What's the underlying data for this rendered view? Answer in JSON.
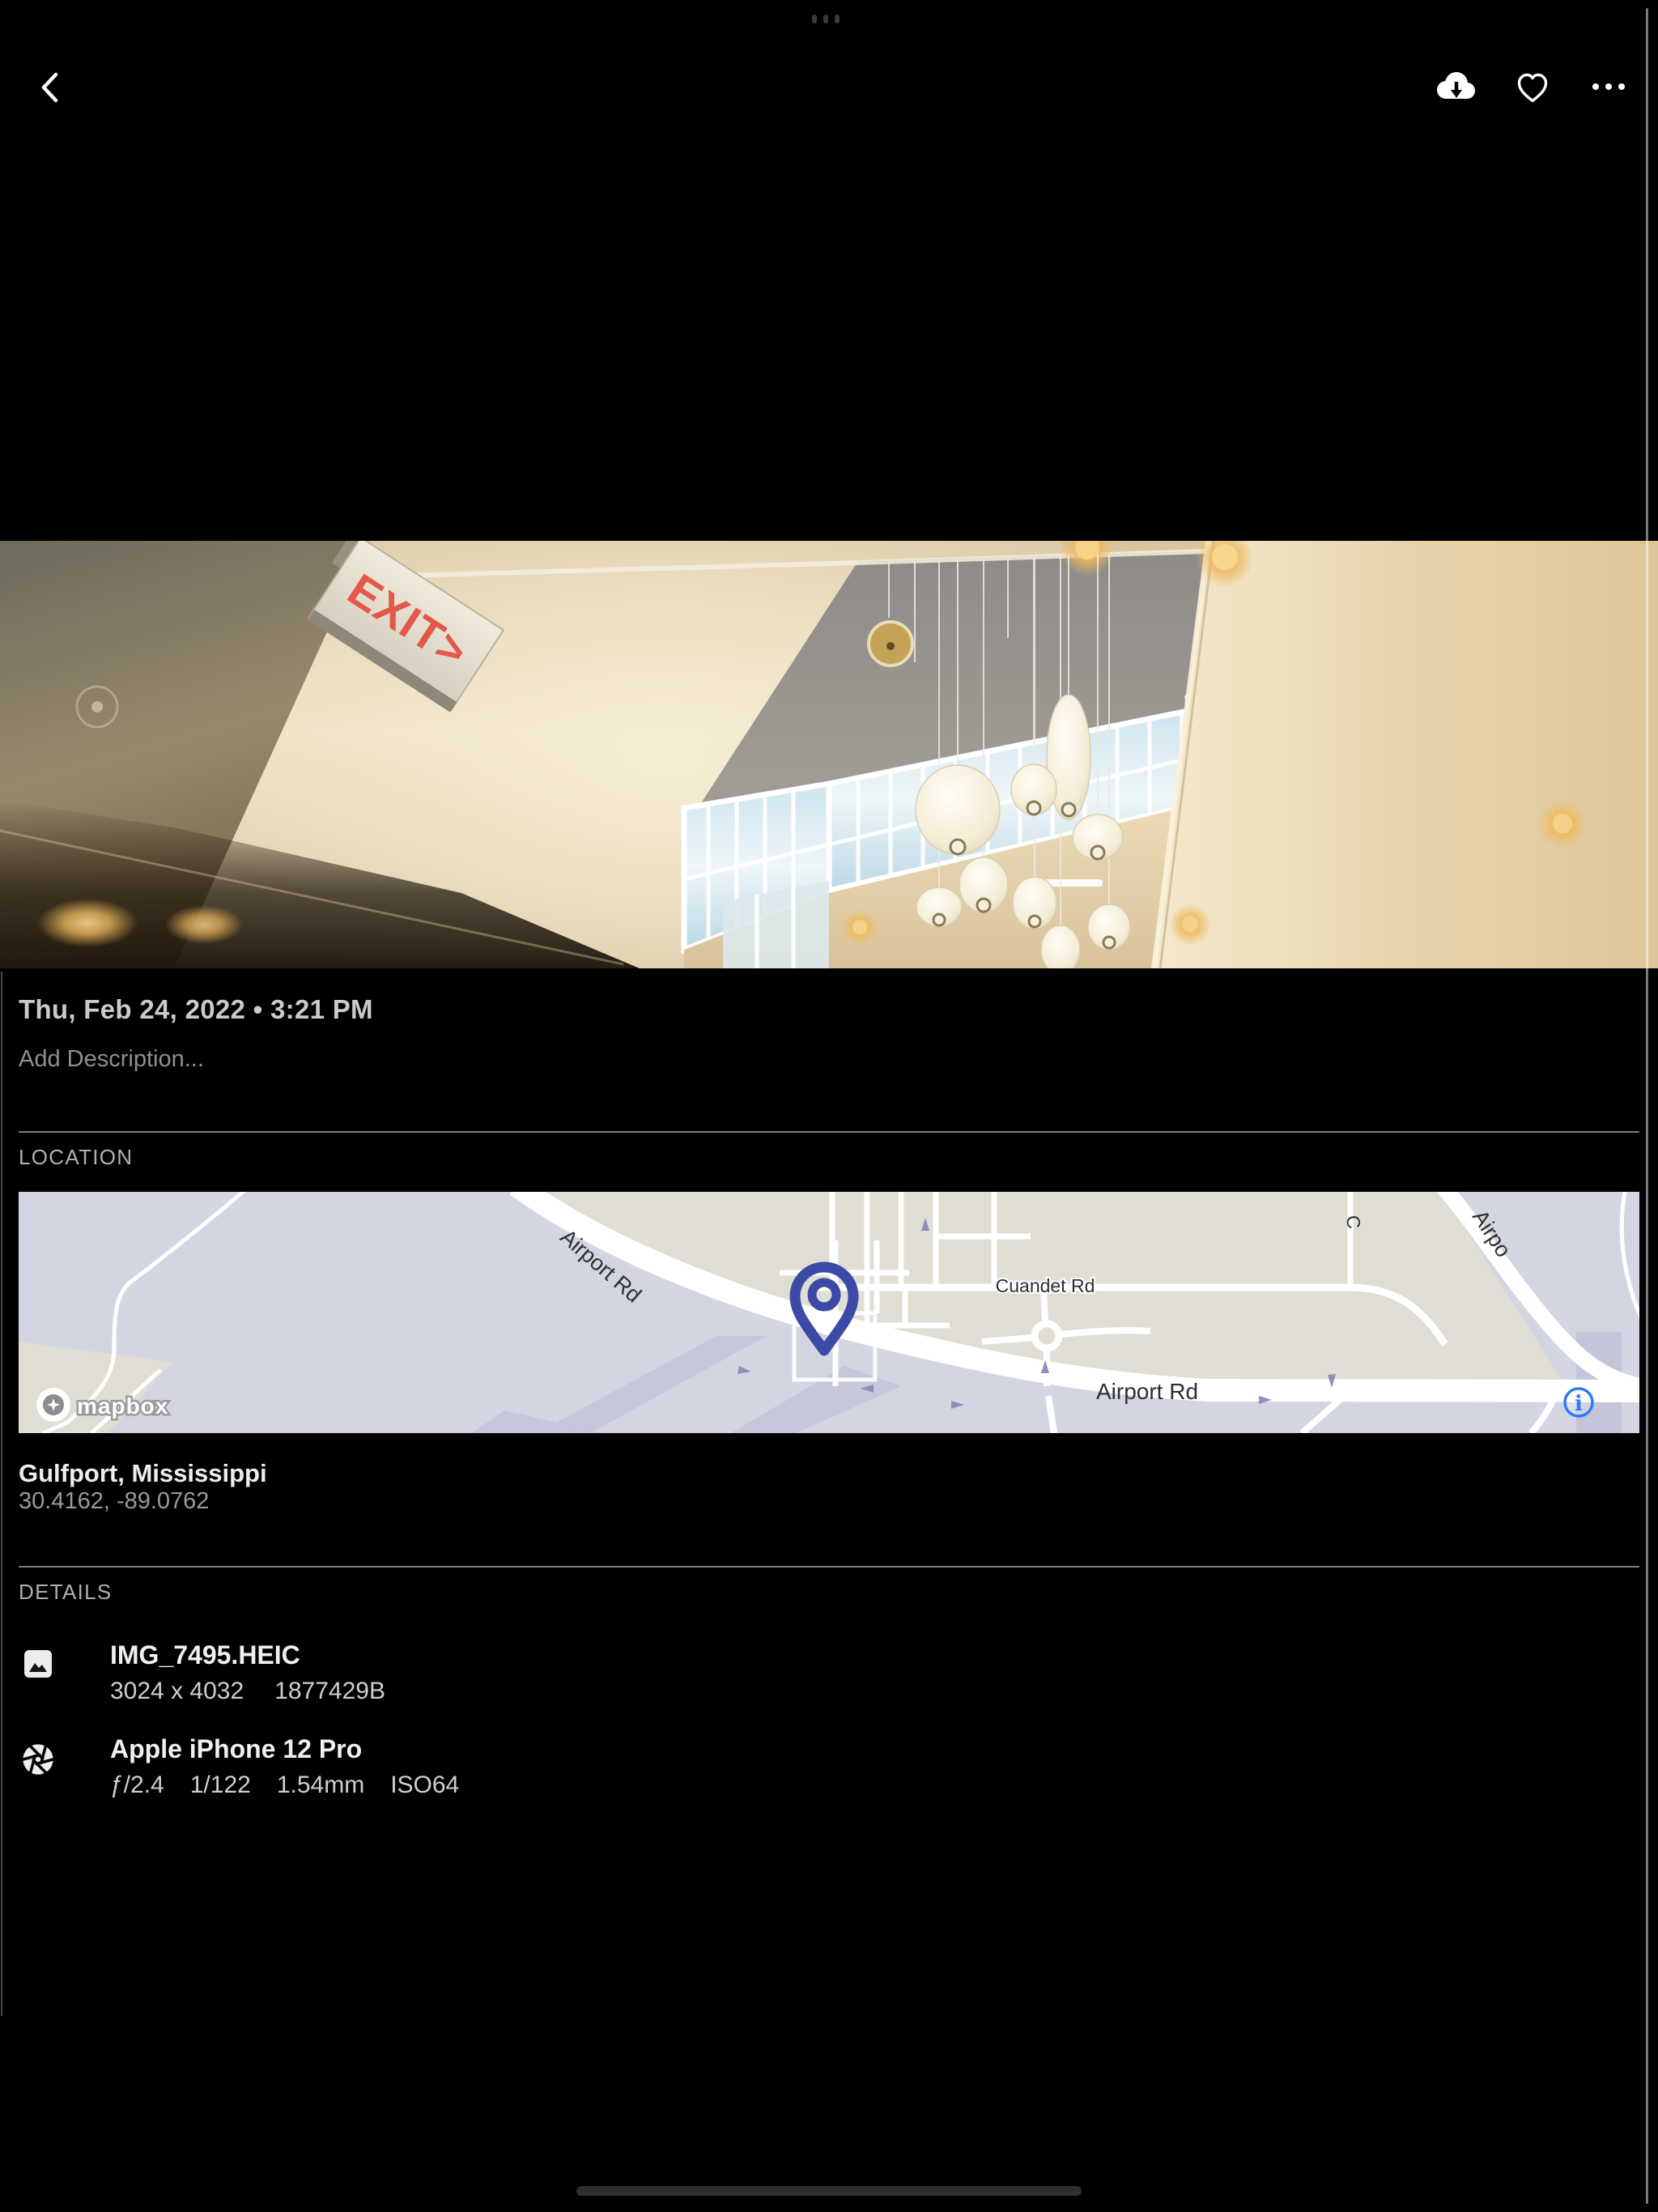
{
  "system": {
    "multitask_indicator_icon": "ellipsis-dots",
    "home_indicator_icon": "home-bar"
  },
  "toolbar": {
    "back_icon": "chevron-left",
    "download_icon": "cloud-download",
    "favorite_icon": "heart-outline",
    "more_icon": "ellipsis-horizontal"
  },
  "photo": {
    "exit_sign": "EXIT>"
  },
  "info": {
    "datetime": "Thu, Feb 24, 2022 • 3:21 PM",
    "description_placeholder": "Add Description..."
  },
  "location": {
    "header": "LOCATION",
    "place": "Gulfport, Mississippi",
    "coordinates": "30.4162, -89.0762",
    "map": {
      "road_label_diagonal": "Airport Rd",
      "road_label_cuandet": "Cuandet Rd",
      "road_label_horizontal": "Airport Rd",
      "road_label_top_right": "Airpo",
      "road_label_top_partial": "C",
      "attribution": "mapbox",
      "info_glyph": "i",
      "pin_color": "#3a4aa6",
      "accent_blue": "#2e7cf6"
    }
  },
  "details": {
    "header": "DETAILS",
    "file": {
      "icon": "image-file",
      "name": "IMG_7495.HEIC",
      "dimensions": "3024 x 4032",
      "size": "1877429B"
    },
    "camera": {
      "icon": "aperture",
      "name": "Apple iPhone 12 Pro",
      "aperture": "ƒ/2.4",
      "shutter_speed": "1/122",
      "focal_length": "1.54mm",
      "iso": "ISO64"
    }
  }
}
